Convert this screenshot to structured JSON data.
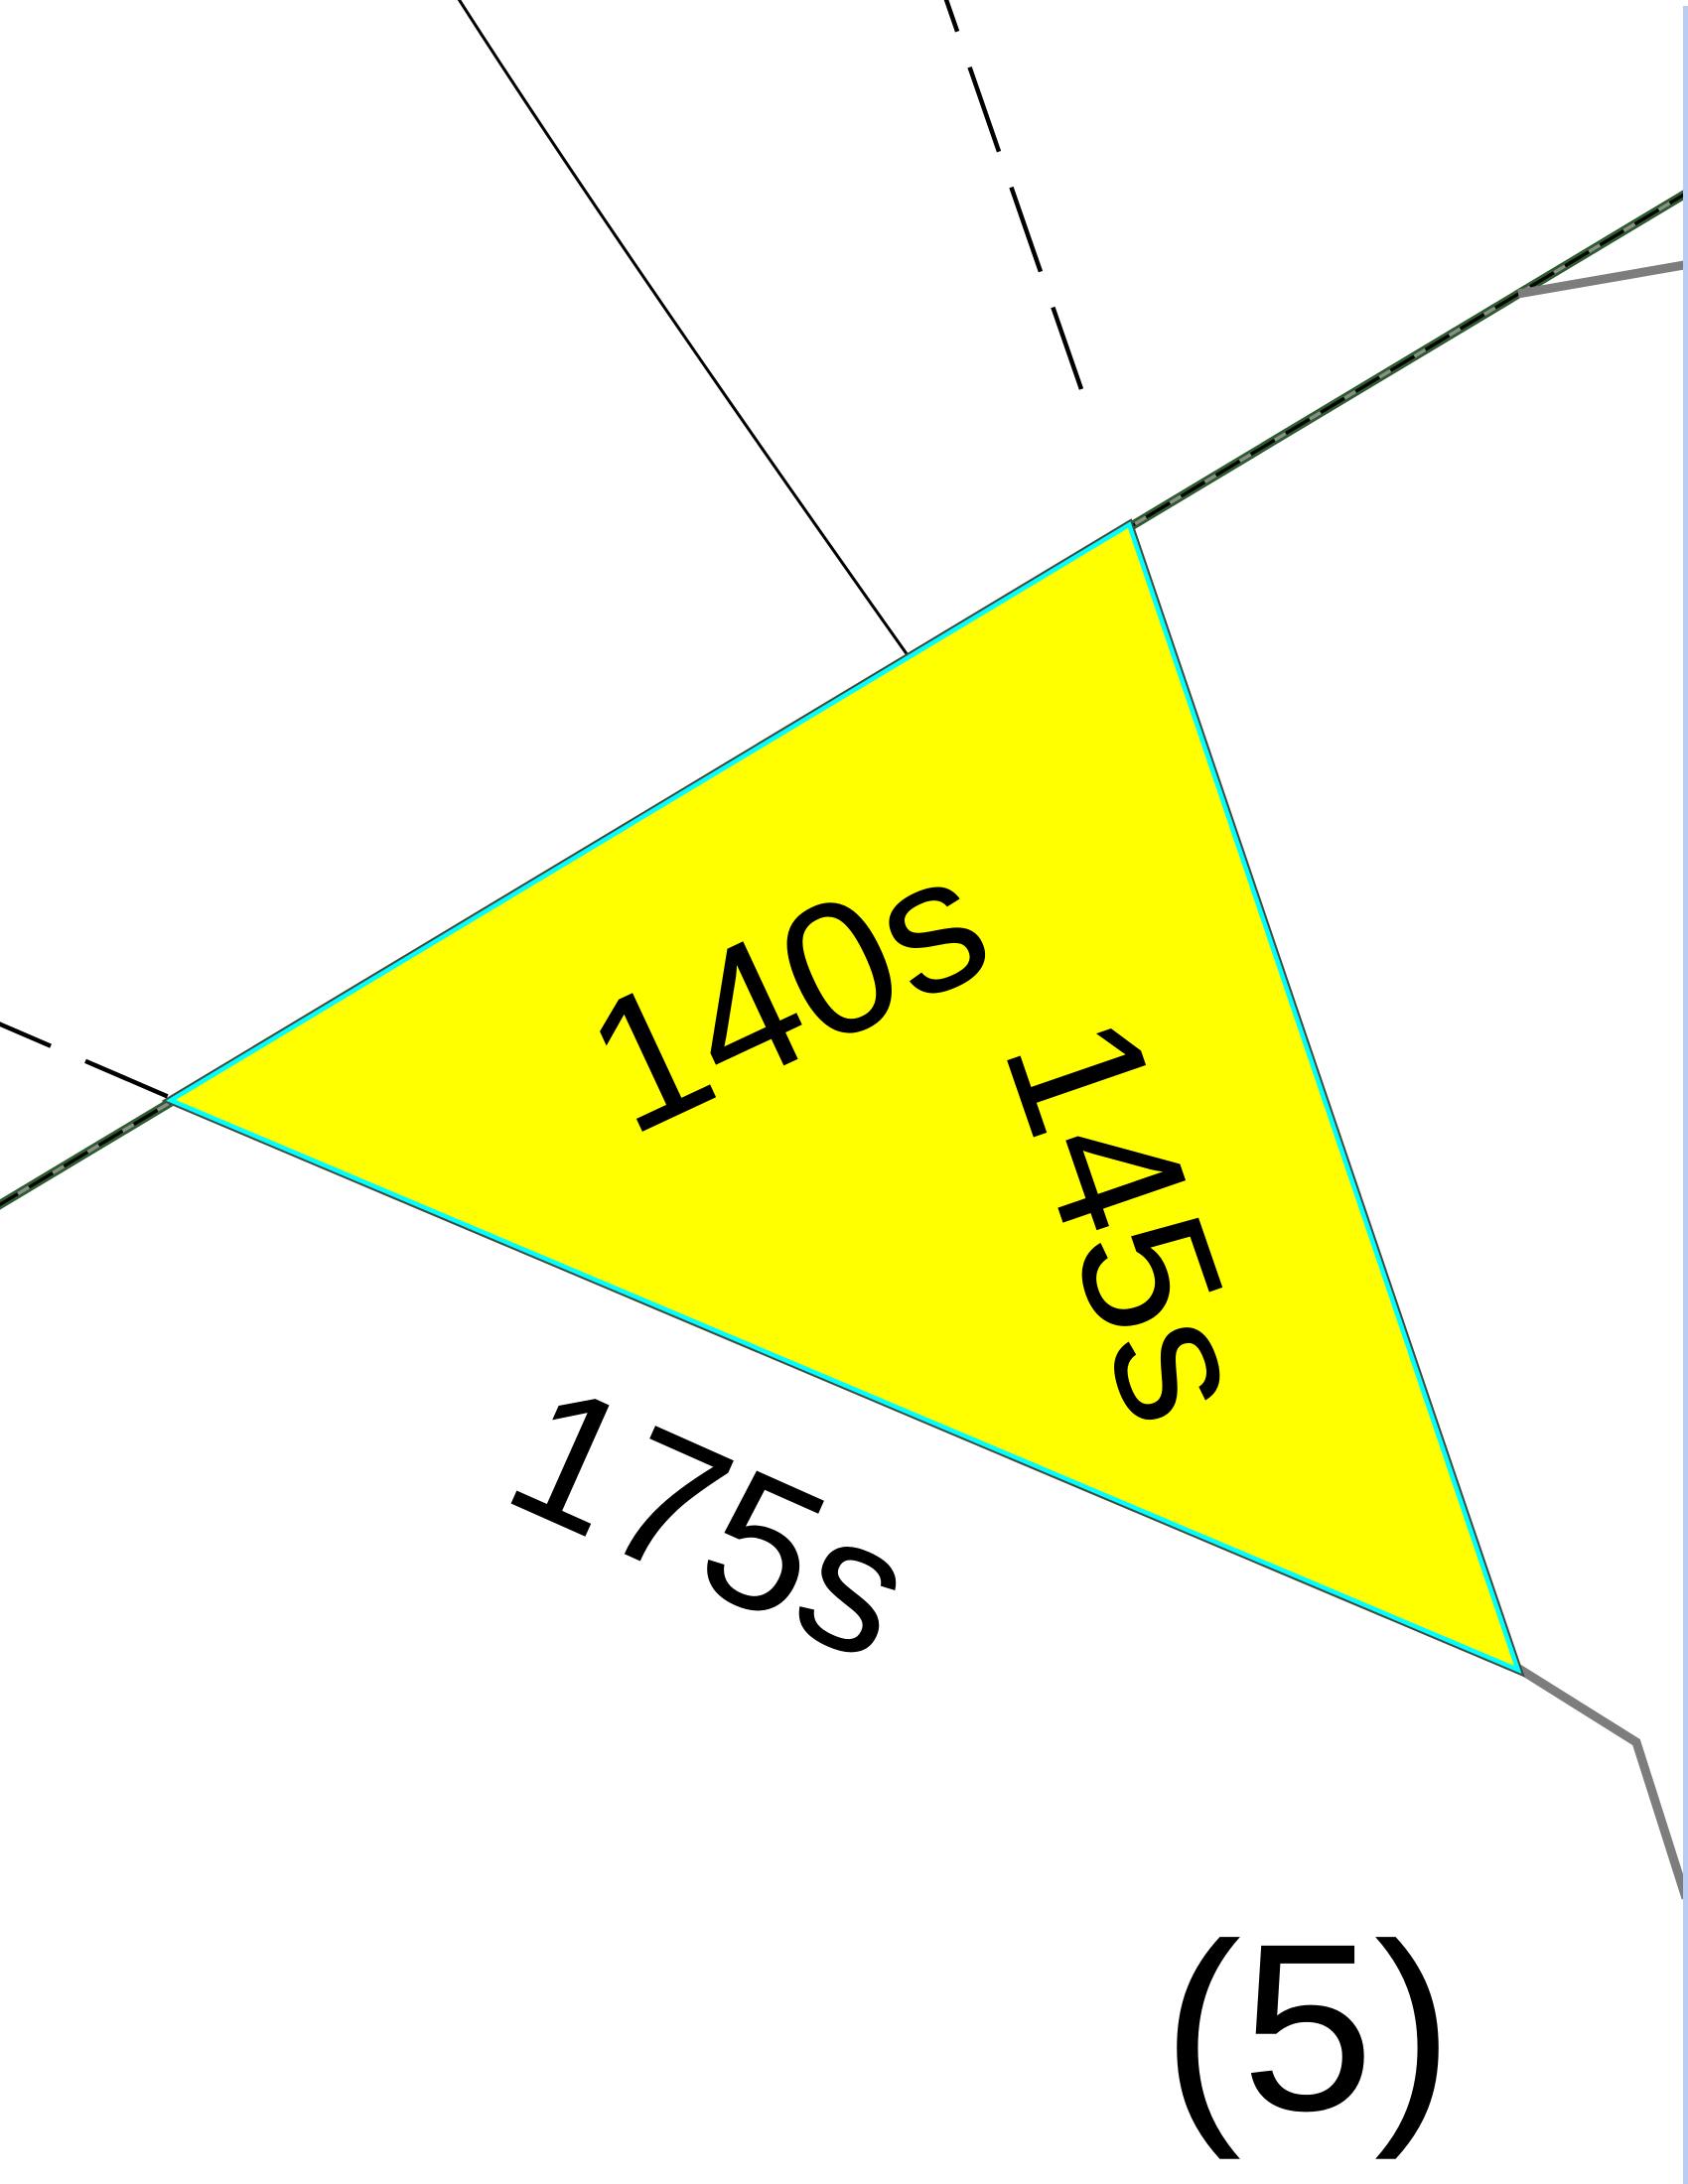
{
  "map": {
    "parcel_labels": {
      "northwest_edge": "140s",
      "southeast_edge": "145s",
      "south_outside": "175s"
    },
    "block_number": "(5)"
  },
  "colors": {
    "background": "#ffffff",
    "parcel_fill": "#ffff00",
    "parcel_highlight": "#00ffff",
    "parcel_outline": "#3f4b3f",
    "road_green": "#2d5c2d",
    "road_dash_gray": "#8c8c8c",
    "road_dash_black": "#000000",
    "thin_line": "#000000",
    "dashed_line": "#000000",
    "gray_line": "#7d7d7d",
    "page_edge_blue": "#b9cdf2",
    "label_text": "#000000"
  }
}
